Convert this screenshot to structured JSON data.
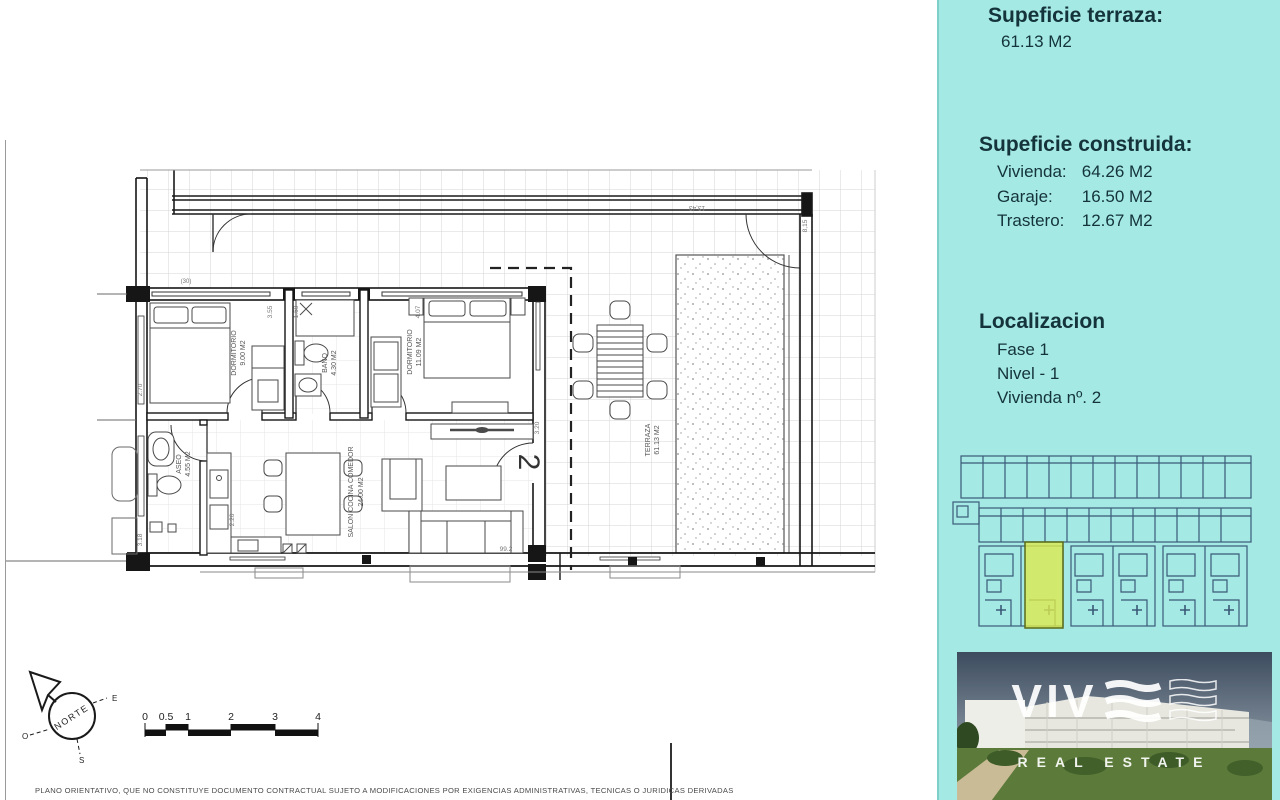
{
  "sidebar": {
    "bg_color": "#a4e9e4",
    "text_color": "#14333b",
    "terraza": {
      "title": "Supeficie terraza:",
      "value": "61.13 M2"
    },
    "construida": {
      "title": "Supeficie construida:",
      "items": [
        {
          "label": "Vivienda:",
          "value": "64.26 M2"
        },
        {
          "label": "Garaje:",
          "value": "16.50 M2"
        },
        {
          "label": "Trastero:",
          "value": "12.67 M2"
        }
      ]
    },
    "localizacion": {
      "title": "Localizacion",
      "items": [
        "Fase 1",
        "Nivel - 1",
        "Vivienda nº. 2"
      ]
    },
    "siteplan": {
      "line_color": "#3b5a78",
      "highlight_color": "#dce94e"
    },
    "photo": {
      "brand": "VIVE",
      "brand_letters": "VIV",
      "tagline": "REAL ESTATE"
    }
  },
  "plan": {
    "unit_number": "2",
    "rooms": [
      {
        "name": "DORMITORIO",
        "area": "9.00 M2"
      },
      {
        "name": "BAÑO",
        "area": "4.30 M2"
      },
      {
        "name": "DORMITORIO",
        "area": "11.09 M2"
      },
      {
        "name": "ASEO",
        "area": "4.55 M2"
      },
      {
        "name": "SALON COCINA COMEDOR",
        "area": "24.00 M2"
      },
      {
        "name": "TERRAZA",
        "area": "61.13 M2"
      }
    ],
    "dims": [
      "3.55",
      "1.60",
      "4.07",
      "13,43",
      "8,15",
      "2.70",
      "3.20",
      "2.20",
      "3.18",
      "99.2",
      "(30)"
    ]
  },
  "compass": {
    "north": "NORTE",
    "east": "E",
    "west": "O",
    "south": "S"
  },
  "scalebar": {
    "ticks": [
      "0",
      "0.5",
      "1",
      "2",
      "3",
      "4"
    ]
  },
  "disclaimer": "PLANO ORIENTATIVO, QUE NO CONSTITUYE DOCUMENTO CONTRACTUAL SUJETO A MODIFICACIONES POR EXIGENCIAS ADMINISTRATIVAS, TECNICAS O JURIDICAS DERIVADAS"
}
